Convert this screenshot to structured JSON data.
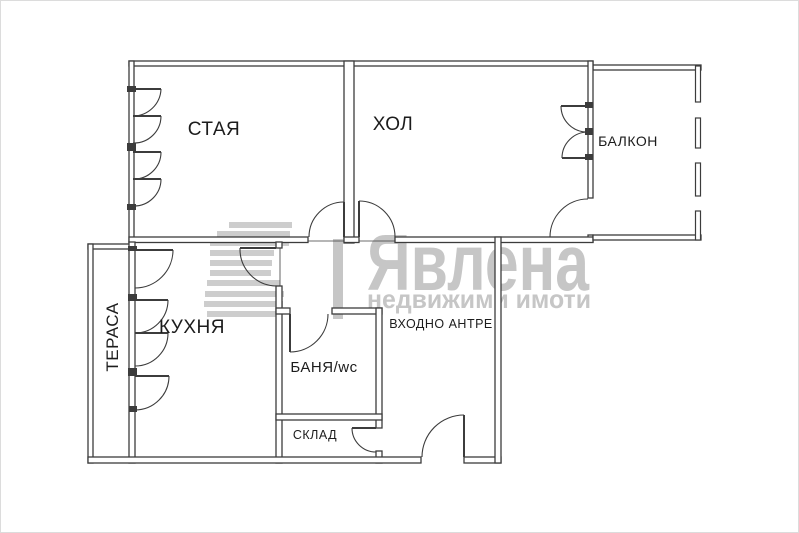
{
  "floorplan": {
    "rooms": {
      "staya": "СТАЯ",
      "hol": "ХОЛ",
      "balkon": "БАЛКОН",
      "terasa": "ТЕРАСА",
      "kuhnya": "КУХНЯ",
      "banya": "БАНЯ/wc",
      "vhodno_antre": "ВХОДНО АНТРЕ",
      "sklad": "СКЛАД"
    },
    "colors": {
      "wall": "#3c3c3c",
      "label": "#1c1c1c"
    }
  },
  "watermark": {
    "brand": "Явлена",
    "tagline": "недвижими имоти",
    "color": "#c6c6c6",
    "stripe_color": "#cdcdcd"
  }
}
